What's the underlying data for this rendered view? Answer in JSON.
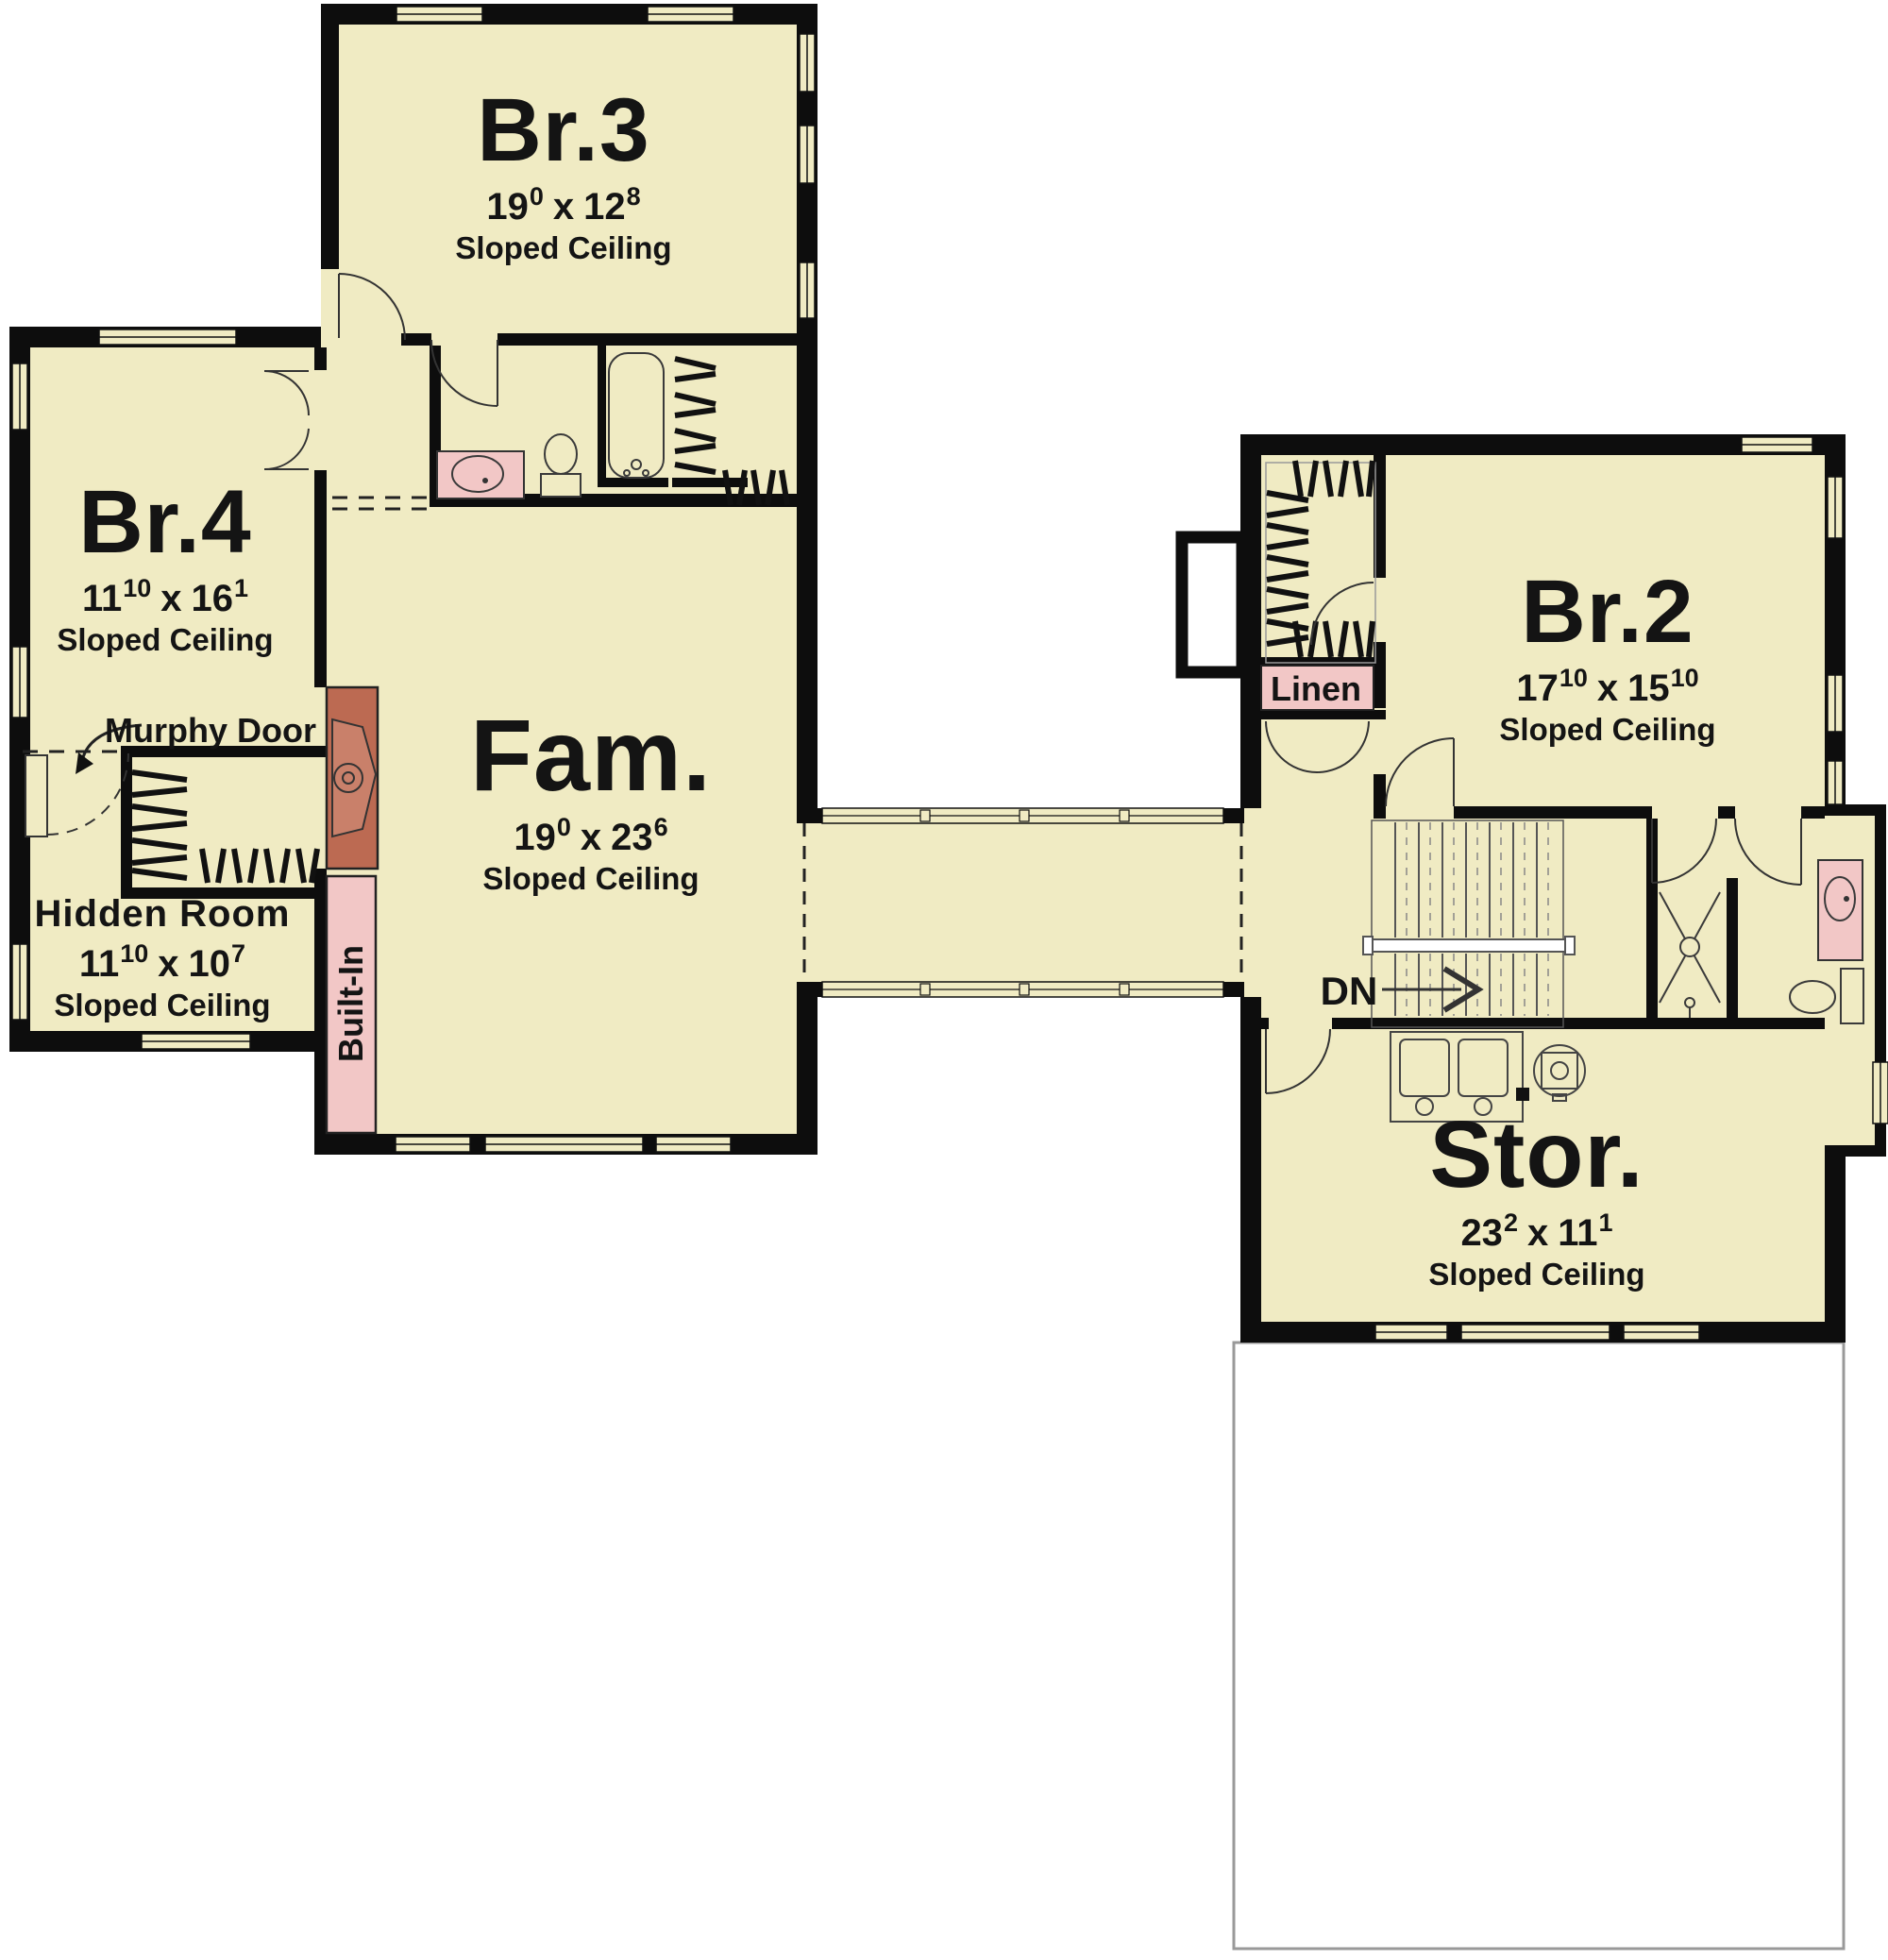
{
  "colors": {
    "room_fill": "#f0ebc3",
    "wall": "#0d0d0d",
    "fixture_pink": "#f2c7c6",
    "fireplace_red": "#bc6a52",
    "exterior": "#ffffff",
    "garage_outline": "#999999"
  },
  "dim_separator": "x",
  "rooms": {
    "br3": {
      "name": "Br.3",
      "width_ft": "19",
      "width_in": "0",
      "length_ft": "12",
      "length_in": "8",
      "note": "Sloped Ceiling"
    },
    "br4": {
      "name": "Br.4",
      "width_ft": "11",
      "width_in": "10",
      "length_ft": "16",
      "length_in": "1",
      "note": "Sloped Ceiling"
    },
    "hidden_room": {
      "name": "Hidden Room",
      "width_ft": "11",
      "width_in": "10",
      "length_ft": "10",
      "length_in": "7",
      "note": "Sloped Ceiling"
    },
    "family": {
      "name": "Fam.",
      "width_ft": "19",
      "width_in": "0",
      "length_ft": "23",
      "length_in": "6",
      "note": "Sloped Ceiling"
    },
    "br2": {
      "name": "Br.2",
      "width_ft": "17",
      "width_in": "10",
      "length_ft": "15",
      "length_in": "10",
      "note": "Sloped Ceiling"
    },
    "storage": {
      "name": "Stor.",
      "width_ft": "23",
      "width_in": "2",
      "length_ft": "11",
      "length_in": "1",
      "note": "Sloped Ceiling"
    }
  },
  "annotations": {
    "murphy_door": "Murphy Door",
    "built_in": "Built-In",
    "linen": "Linen",
    "down": "DN"
  }
}
